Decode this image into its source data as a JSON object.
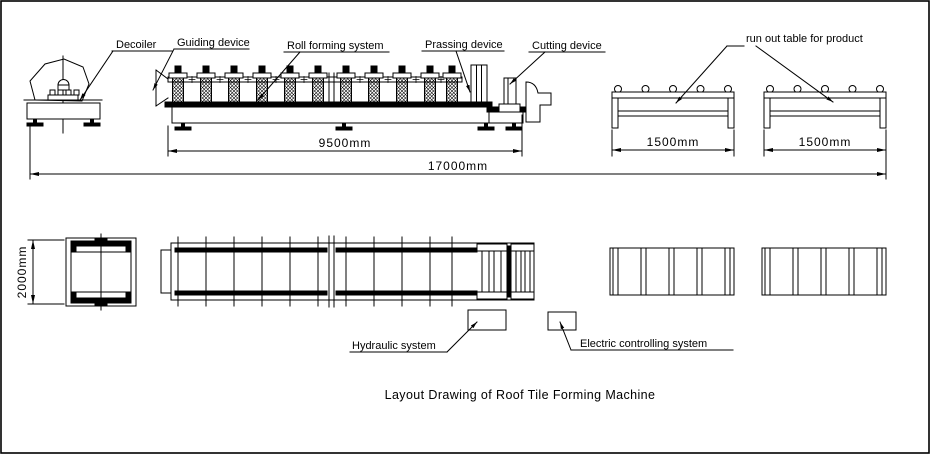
{
  "drawing": {
    "title": "Layout Drawing of Roof Tile Forming Machine",
    "labels": {
      "decoiler": "Decoiler",
      "guiding_device": "Guiding device",
      "roll_forming_system": "Roll forming system",
      "pressing_device": "Prassing device",
      "cutting_device": "Cutting device",
      "run_out_table": "run out table for product",
      "hydraulic_system": "Hydraulic system",
      "electric_controlling_system": "Electric controlling system"
    },
    "dimensions": {
      "roll_former_length": "9500mm",
      "overall_length": "17000mm",
      "run_out_table_1_length": "1500mm",
      "run_out_table_2_length": "1500mm",
      "decoiler_width": "2000mm"
    },
    "colors": {
      "line": "#000000",
      "background": "#ffffff"
    }
  }
}
